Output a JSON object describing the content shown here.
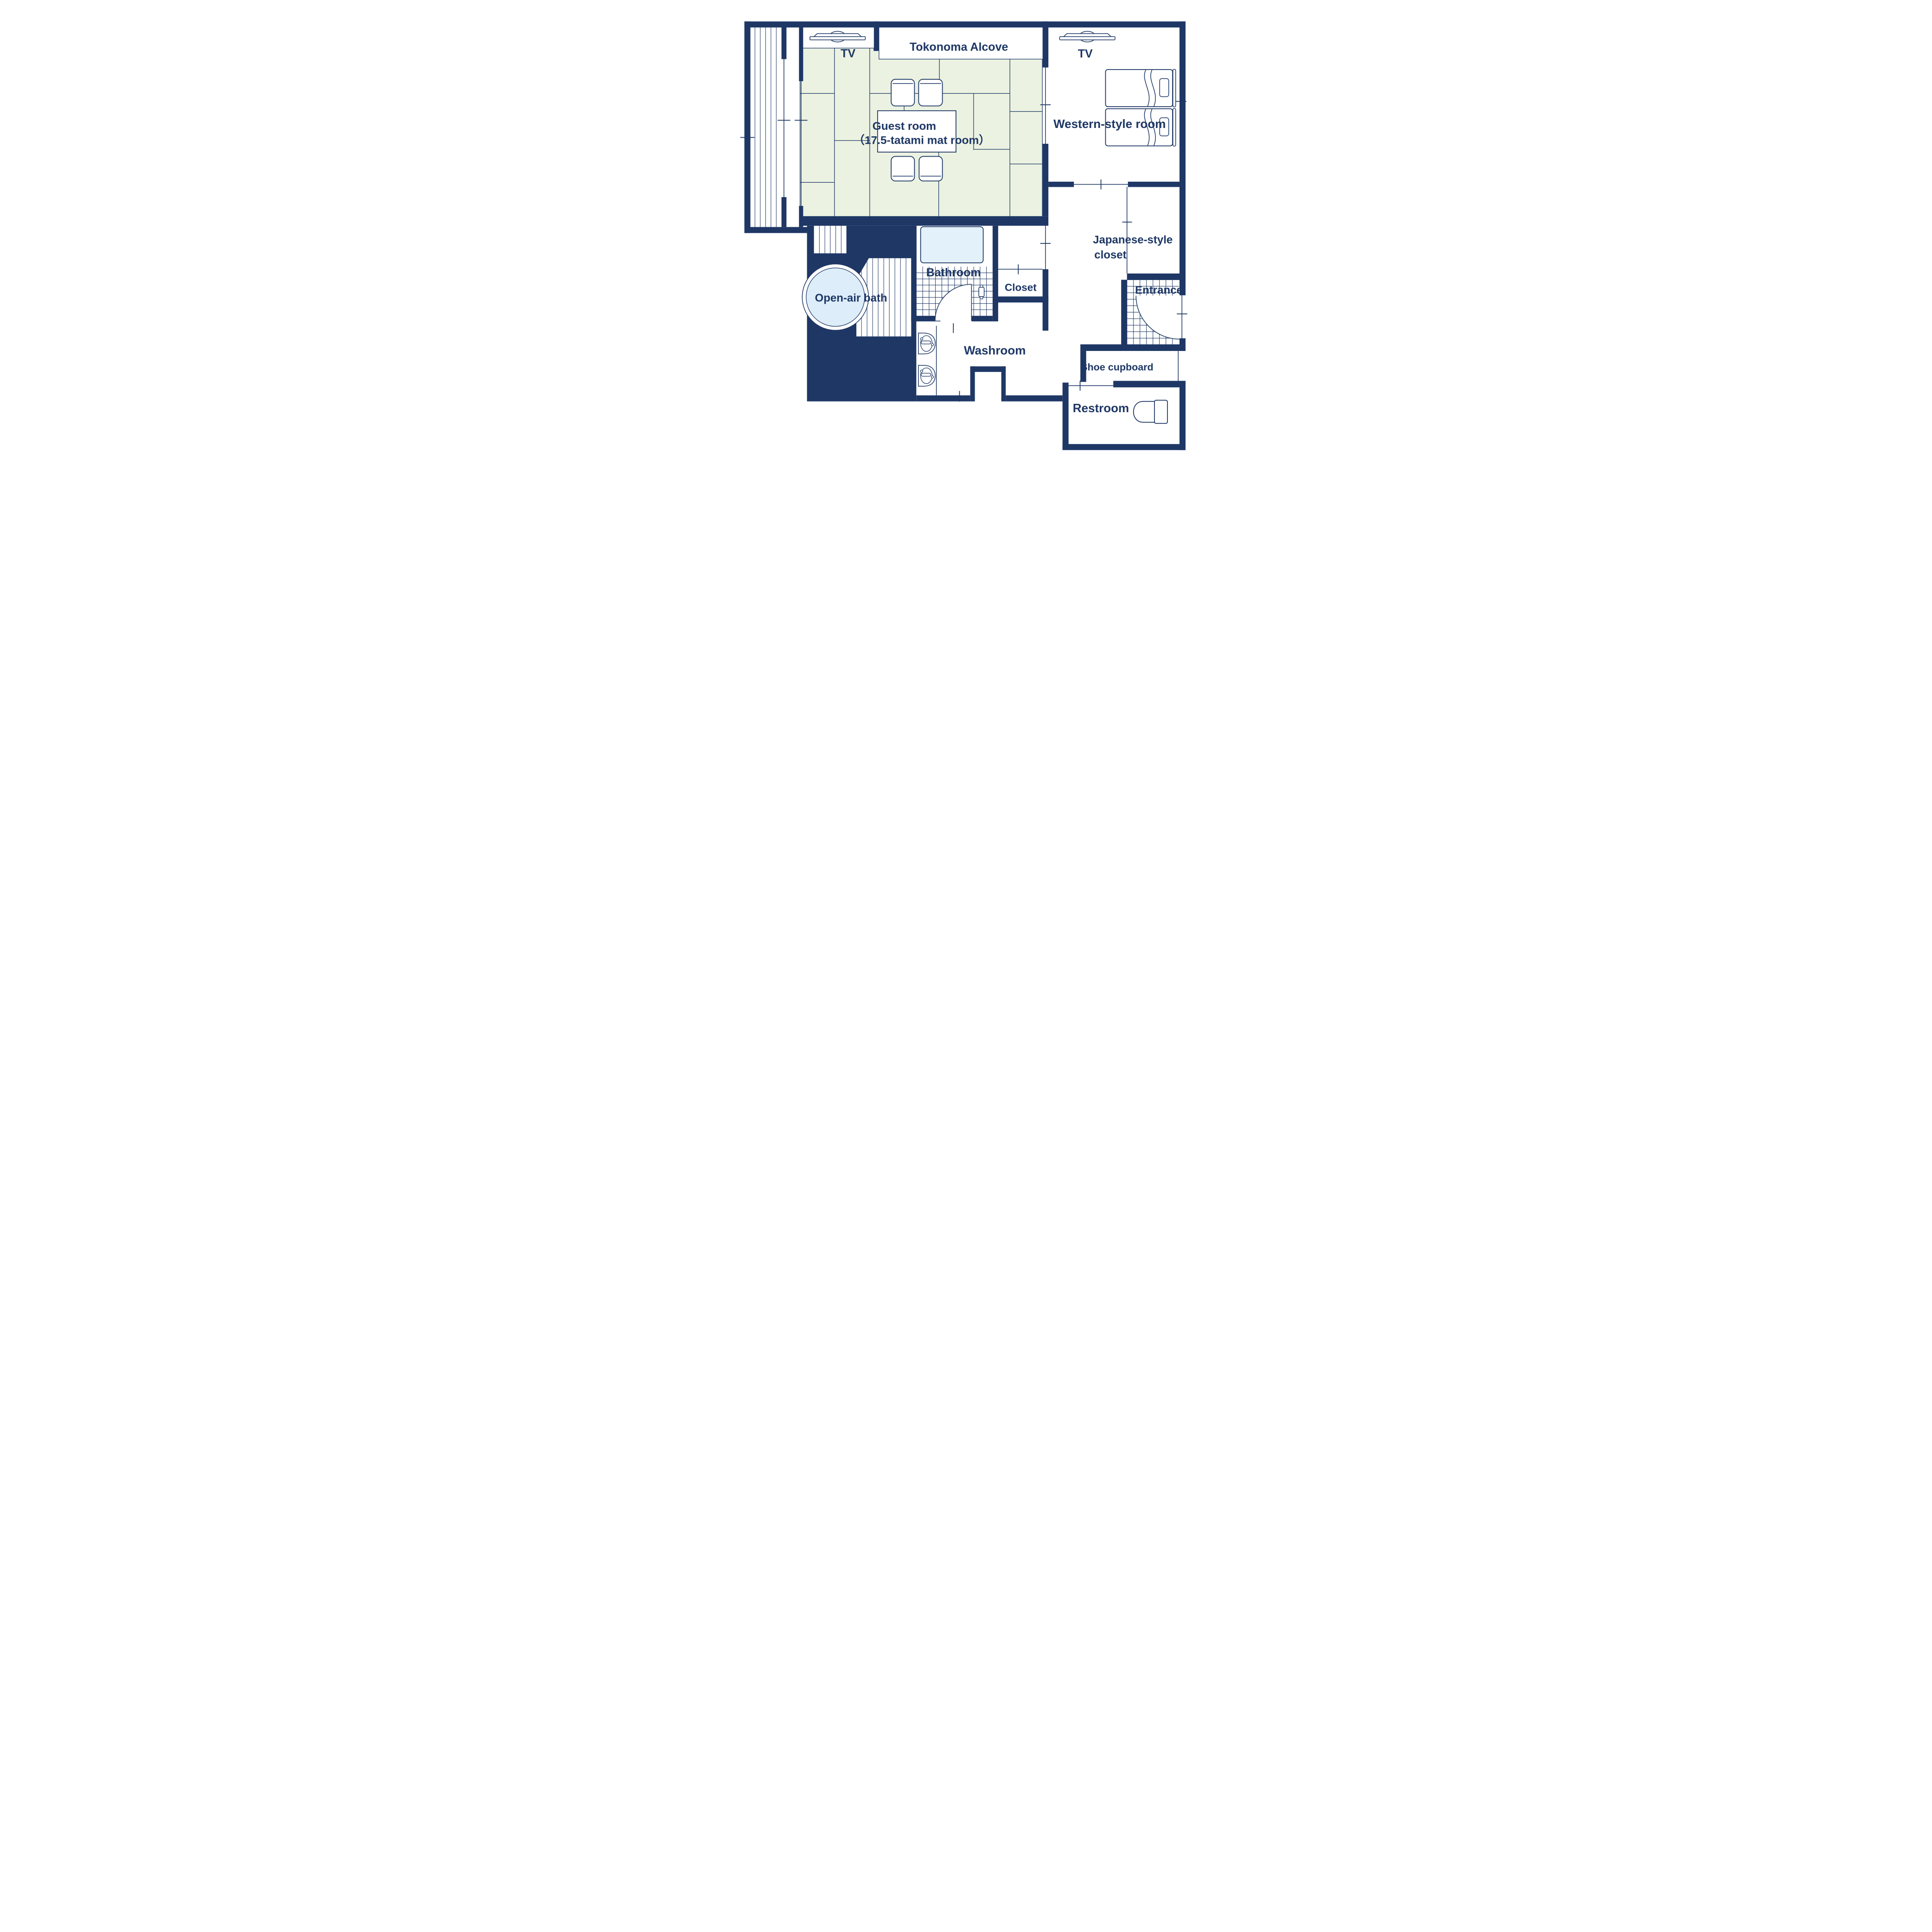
{
  "floor_plan": {
    "title": "Japanese ryokan guest-room floor plan",
    "rooms": {
      "guest_room": {
        "label_line1": "Guest room",
        "label_line2": "（17.5-tatami mat room）"
      },
      "tokonoma": {
        "label": "Tokonoma Alcove"
      },
      "western_room": {
        "label": "Western-style room"
      },
      "japanese_closet": {
        "label_line1": "Japanese-style",
        "label_line2": "closet"
      },
      "closet": {
        "label": "Closet"
      },
      "entrance": {
        "label": "Entrance"
      },
      "bathroom": {
        "label": "Bathroom"
      },
      "open_air_bath": {
        "label": "Open-air bath"
      },
      "washroom": {
        "label": "Washroom"
      },
      "shoe_cupboard": {
        "label": "Shoe cupboard"
      },
      "restroom": {
        "label": "Restroom"
      }
    },
    "tv_labels": {
      "guest": "TV",
      "western": "TV"
    },
    "icons": [
      "tv-icon",
      "twin-bed-icon",
      "pillow-icon",
      "low-table",
      "floor-chair-icon",
      "bathtub-icon",
      "round-open-air-tub-icon",
      "washbasin-icon",
      "toilet-icon",
      "swing-door-arc",
      "sliding-door-line",
      "tile-grid",
      "wood-deck-planks"
    ],
    "colors": {
      "wall": "#1e3765",
      "tatami_green": "#ebf2e1",
      "bath_water_blue": "#e3f1fb",
      "open_air_pool_blue": "#ddeefa",
      "background": "#ffffff"
    }
  }
}
